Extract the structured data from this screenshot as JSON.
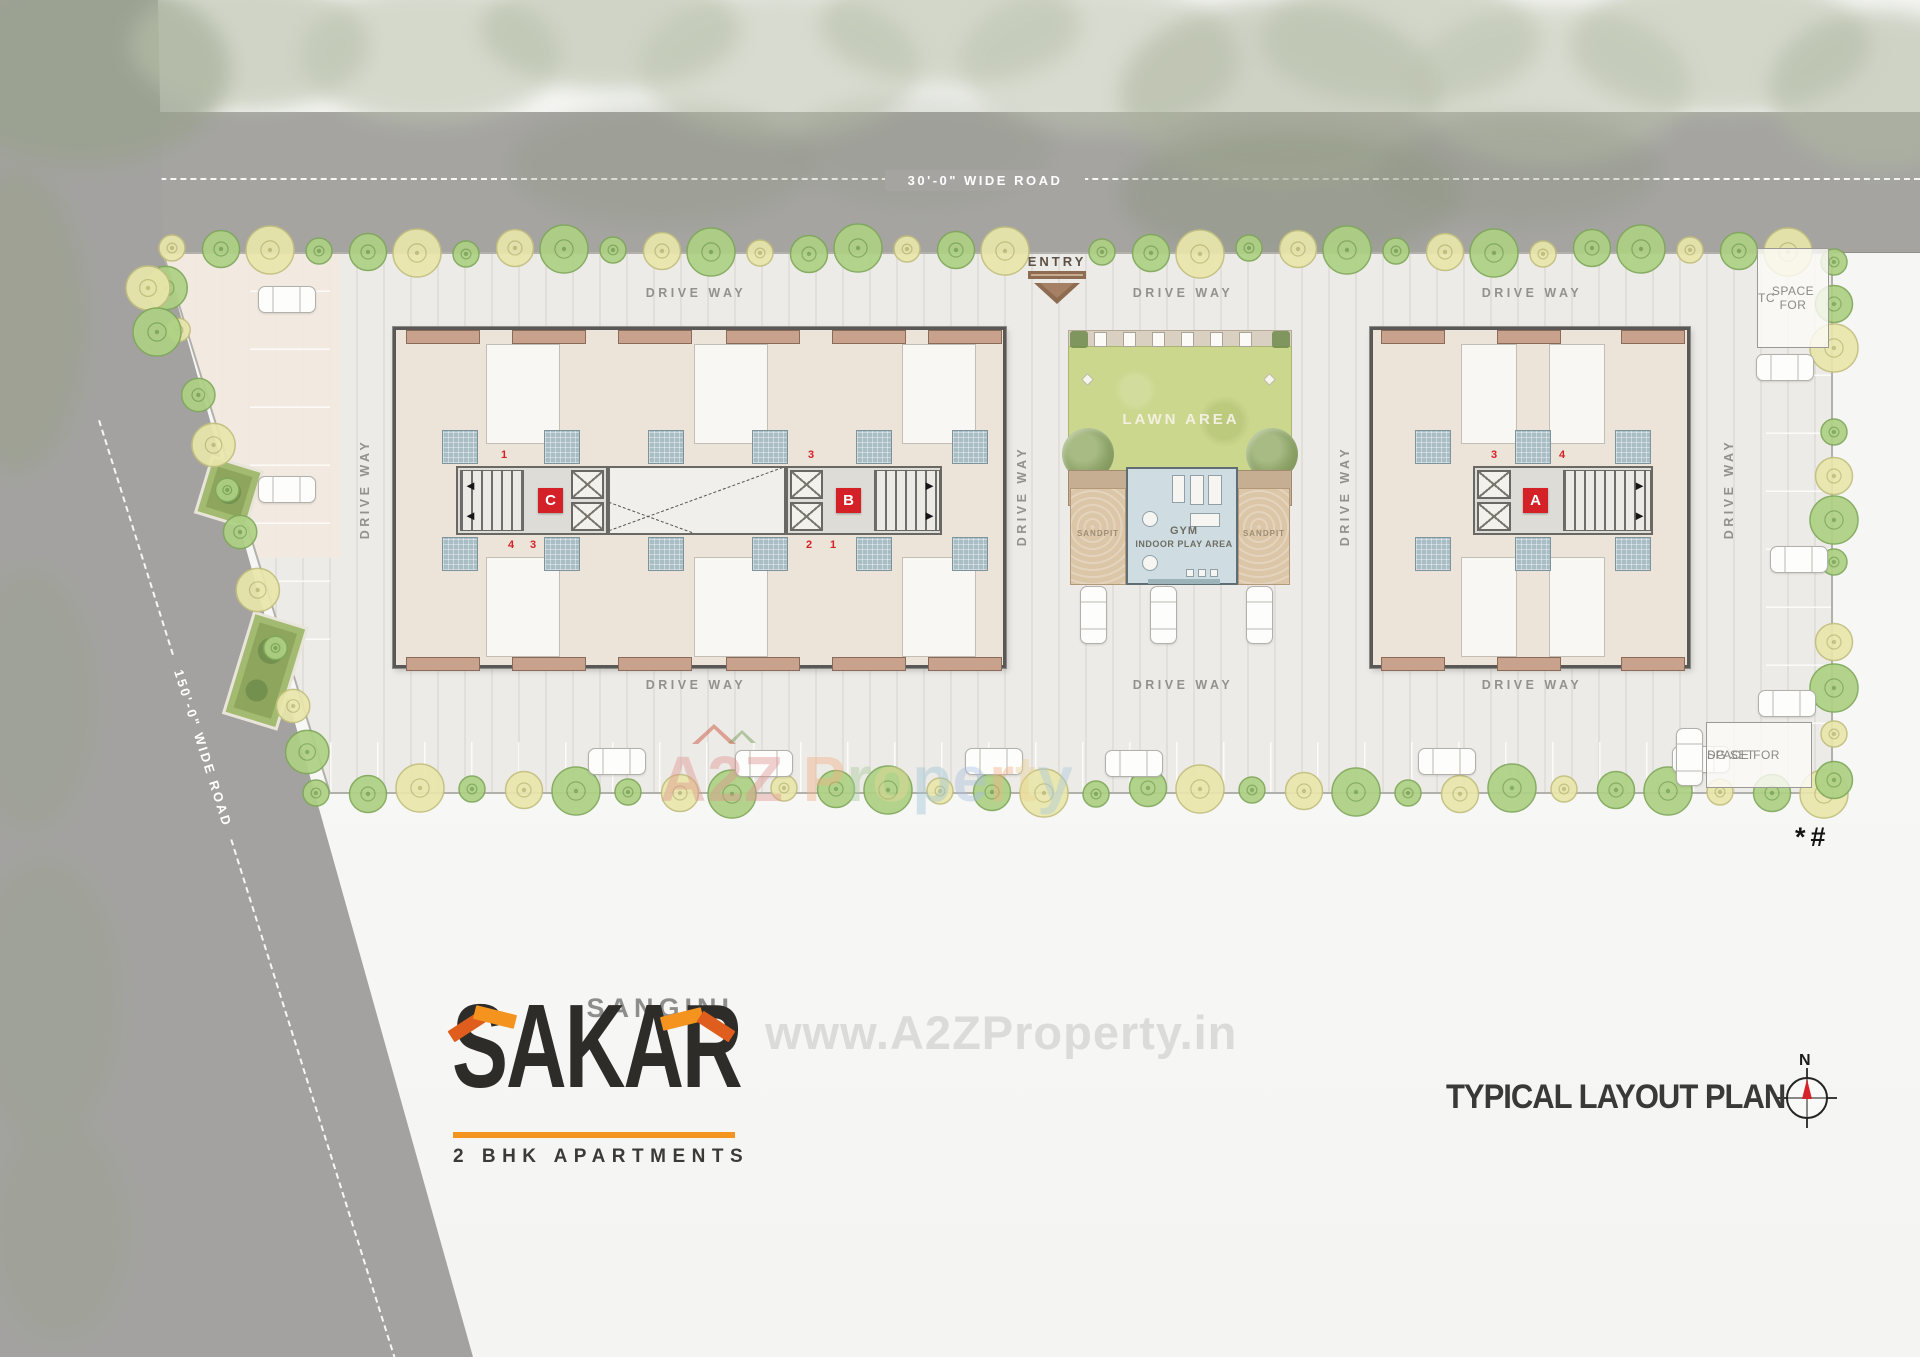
{
  "labels": {
    "road_top": "30'-0\" WIDE ROAD",
    "road_left": "150'-0\" WIDE ROAD",
    "entry": "ENTRY",
    "drive_way": "DRIVE WAY",
    "footnote": "*#"
  },
  "amenities": {
    "lawn": "LAWN AREA",
    "gym_line1": "GYM",
    "gym_line2": "INDOOR PLAY AREA",
    "sandpit_left": "SANDPIT",
    "sandpit_right": "SANDPIT"
  },
  "utilities": {
    "tc_line1": "SPACE FOR",
    "tc_line2": "TC",
    "dg_line1": "SPACE FOR",
    "dg_line2": "DG SET"
  },
  "buildings": {
    "c": {
      "label": "C",
      "units_top": [
        "1",
        "2"
      ],
      "units_bottom": [
        "4",
        "3"
      ]
    },
    "b": {
      "label": "B",
      "units_top": [
        "3",
        "4"
      ],
      "units_bottom": [
        "2",
        "1"
      ]
    },
    "a": {
      "label": "A",
      "units_top": [
        "3",
        "4"
      ],
      "units_bottom": [
        "2",
        "1"
      ]
    }
  },
  "logo": {
    "brand": "SANGINI",
    "name": "SAKAR",
    "tagline": "2 BHK APARTMENTS"
  },
  "title_block": {
    "plan_title": "TYPICAL LAYOUT PLAN",
    "north": "N"
  },
  "watermark": {
    "main": "A2Z Property",
    "url": "www.A2ZProperty.in",
    "a2z_color": "#E09490",
    "palette": [
      "#A9C0E2",
      "#F2B184",
      "#EAD292",
      "#A9C8DC",
      "#F2B184",
      "#A8CC9C",
      "#E8D898",
      "#9CC4D4"
    ]
  },
  "colors": {
    "accent_orange": "#F4941E",
    "accent_red_orange": "#DF5E1D",
    "badge_red": "#D42127",
    "road_gray": "#A5A4A1",
    "lawn_green": "#CBD78D",
    "tree_green": "#AED184",
    "tree_yellow": "#E9E7AB"
  }
}
